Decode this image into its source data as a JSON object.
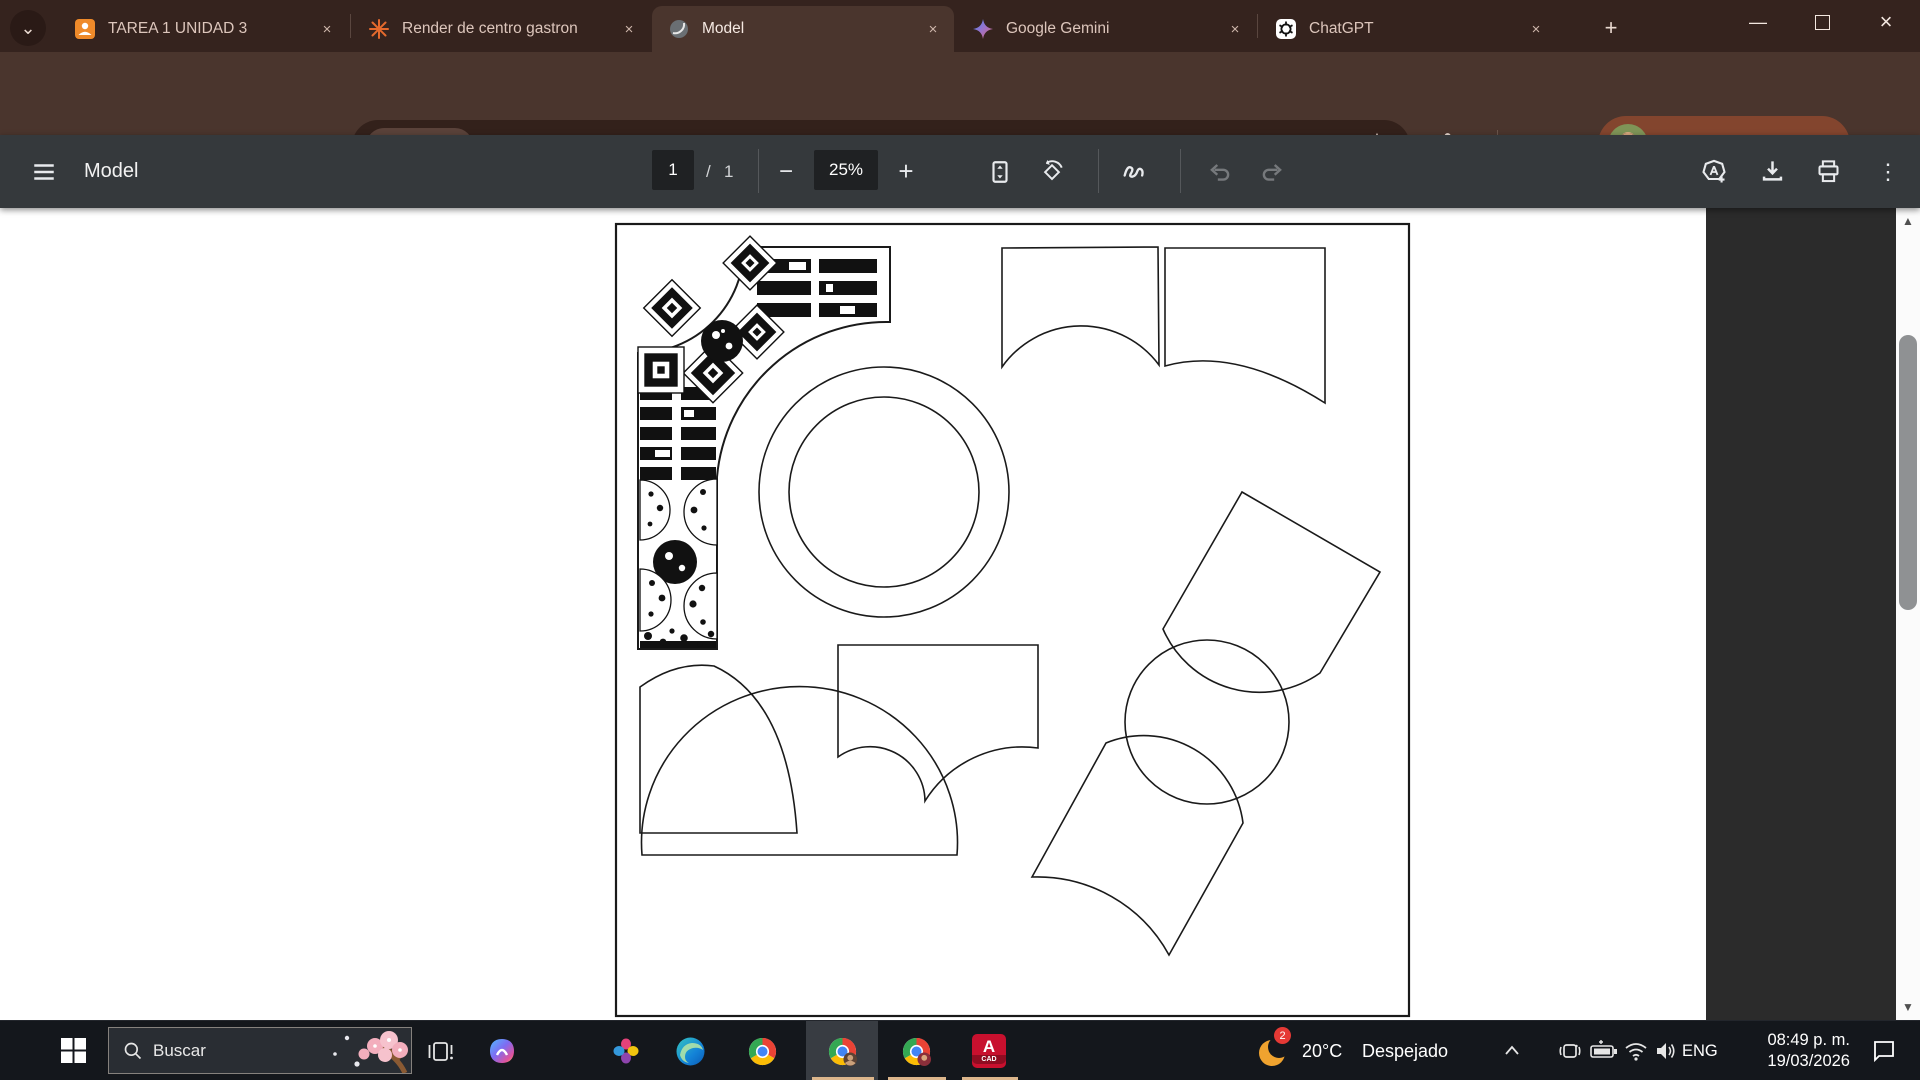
{
  "browser": {
    "tab_search_glyph": "⌄",
    "tabs": [
      {
        "title": "TAREA 1 UNIDAD 3"
      },
      {
        "title": "Render de centro gastron"
      },
      {
        "title": "Model"
      },
      {
        "title": "Google Gemini"
      },
      {
        "title": "ChatGPT"
      }
    ],
    "close_glyph": "×",
    "new_tab_glyph": "+",
    "window_controls": {
      "minimize": "—",
      "close": "×"
    },
    "nav": {
      "back": "←",
      "forward": "→"
    },
    "address": {
      "chip": "Archivo",
      "url": "C:/Users/PCgam/OneDrive/Documents/CENTRO%20GASTRONOMICO%20PLANTA%20DE%20CONJUNT..."
    },
    "profile": {
      "label": "Institución educativa"
    },
    "menu_glyph": "⋮"
  },
  "pdf": {
    "title": "Model",
    "page_current": "1",
    "page_separator": "/",
    "page_total": "1",
    "zoom_level": "25%",
    "minus_glyph": "−",
    "plus_glyph": "+",
    "menu_glyph": "⋮",
    "scroll_up_glyph": "▲",
    "scroll_down_glyph": "▼"
  },
  "taskbar": {
    "search_placeholder": "Buscar",
    "weather": {
      "temperature": "20°C",
      "condition": "Despejado",
      "badge": "2"
    },
    "language": "ENG",
    "clock": {
      "time": "08:49 p. m.",
      "date": "19/03/2026"
    },
    "cad_label": {
      "letter": "A",
      "sub": "CAD"
    }
  },
  "colors": {
    "accent_underline": "#dcb68c",
    "frame": "#35231e",
    "active_tab": "#4a352d",
    "pdf_toolbar": "#35393c",
    "viewer_bg": "#2b2b2b",
    "profile_chip": "#83452e"
  }
}
